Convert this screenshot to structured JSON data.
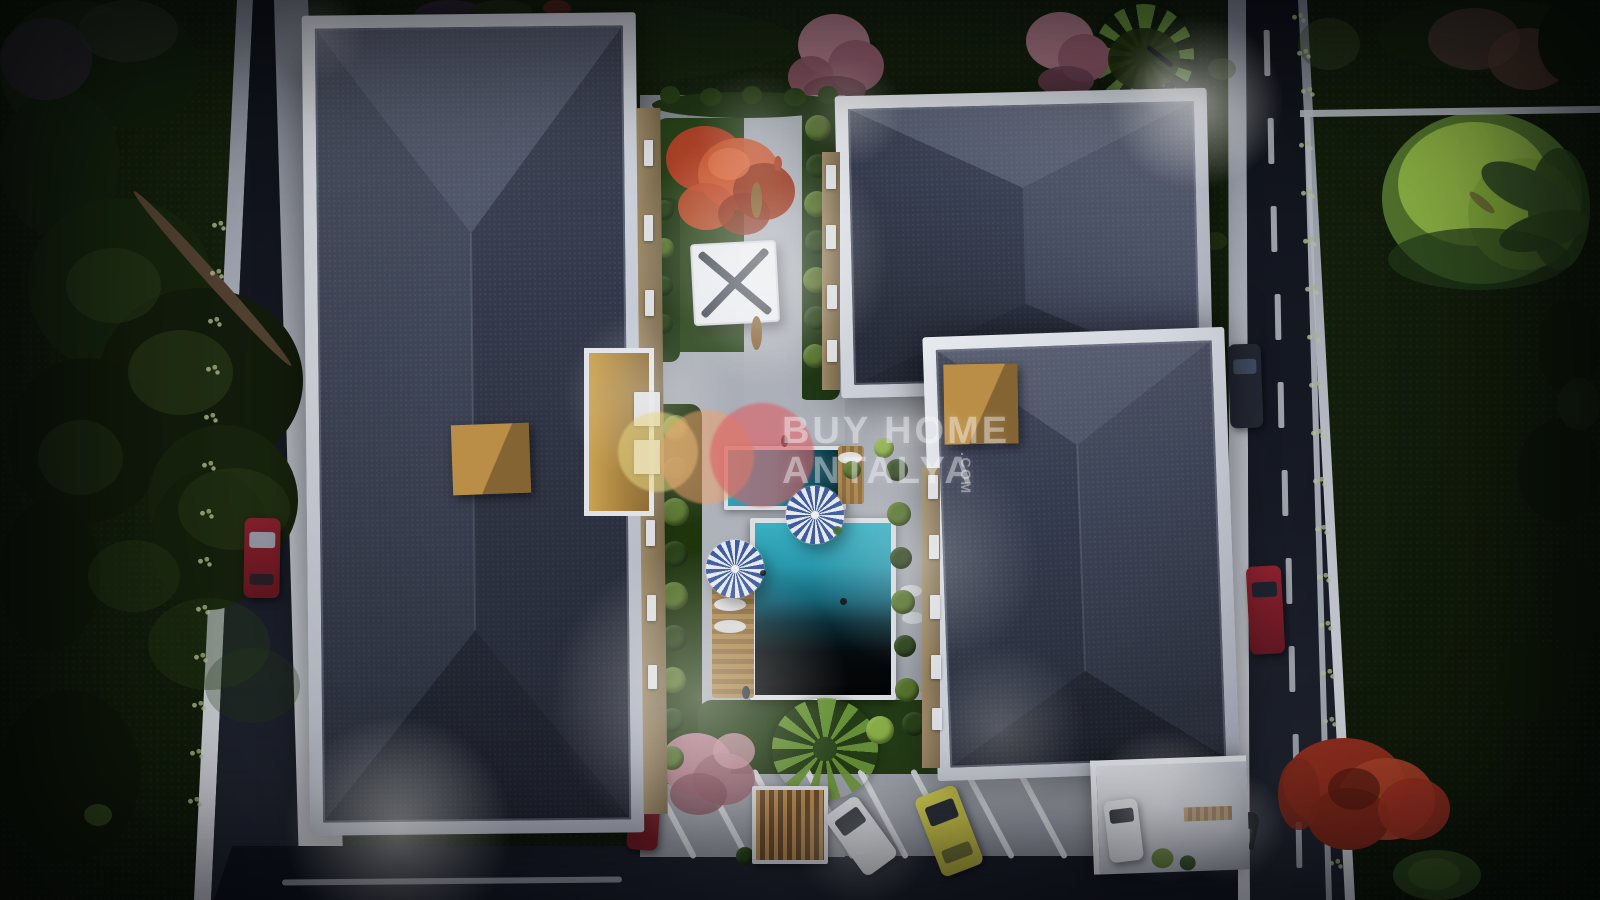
{
  "description": "Aerial night 3D rendering of a two-block residential complex with central courtyard pool, watermarked BUY HOME ANTALYA",
  "watermark": {
    "line1": "BUY HOME",
    "line2": "ANTALYA",
    "suffix": ".COM"
  },
  "palette": {
    "grass_dark": "#0e180a",
    "grass_mid": "#16240e",
    "road_asphalt": "#181c28",
    "sidewalk": "#d8dce3",
    "building_white": "#e9ebef",
    "roof_base": "#3b4153",
    "roof_light": "#4c5368",
    "roof_dark": "#2e3444",
    "courtyard": "#aaaeb6",
    "pool_teal": "#2aa3ba",
    "pool_shadow": "#06080b",
    "parasol_blue": "#3f5ea6",
    "parasol_white": "#eef1f6",
    "wood": "#b08a50",
    "tan_box": "#ab8143",
    "bush_dark": "#2c471b",
    "bush_light": "#5d7c30",
    "bush_lime": "#8fb54a",
    "tree_red": "#c7502f",
    "tree_pink": "#c08b97",
    "tree_flame": "#b03524",
    "willow": "#9fca46",
    "car_red": "#8e2030",
    "car_dark": "#262b38",
    "car_white": "#dfe2e6",
    "car_yellow": "#d6d14f",
    "watermark_text": "rgba(250,250,252,0.42)",
    "logo_yellow": "rgba(232,214,130,0.55)",
    "logo_peach": "rgba(235,160,110,0.55)",
    "logo_red": "rgba(222,95,100,0.6)"
  },
  "scene": {
    "blobs": [
      [
        0,
        0,
        150,
        140,
        "#1a2b10",
        1,
        0,
        2
      ],
      [
        60,
        8,
        140,
        120,
        "#14230d",
        1,
        0,
        2
      ],
      [
        0,
        88,
        120,
        150,
        "#16260f",
        1,
        0,
        2
      ],
      [
        28,
        198,
        185,
        175,
        "#18290f",
        1,
        0,
        2
      ],
      [
        98,
        288,
        205,
        185,
        "#141f0c",
        1,
        0,
        2
      ],
      [
        8,
        358,
        155,
        165,
        "#121d0b",
        1,
        0,
        2
      ],
      [
        148,
        425,
        150,
        150,
        "#19270e",
        1,
        0,
        2
      ],
      [
        150,
        470,
        120,
        140,
        "#16230d",
        1,
        0,
        2
      ],
      [
        0,
        500,
        100,
        150,
        "#111c0a",
        1,
        0,
        2
      ],
      [
        0,
        690,
        140,
        170,
        "#101a09",
        1,
        0,
        2
      ],
      [
        66,
        248,
        95,
        75,
        "#2e441b",
        0.5,
        0,
        2
      ],
      [
        128,
        330,
        105,
        85,
        "#33491c",
        0.5,
        0,
        2
      ],
      [
        38,
        420,
        85,
        75,
        "#2a3f19",
        0.45,
        0,
        2
      ],
      [
        178,
        468,
        112,
        82,
        "#31471c",
        0.4,
        0,
        2
      ],
      [
        88,
        540,
        92,
        72,
        "#2c411a",
        0.4,
        0,
        2
      ],
      [
        148,
        598,
        122,
        92,
        "#2e441b",
        0.35,
        0,
        2
      ],
      [
        205,
        648,
        95,
        75,
        "#2c411a",
        0.3,
        0,
        2
      ],
      [
        0,
        18,
        92,
        82,
        "#3a2f42",
        0.6,
        0,
        2
      ],
      [
        78,
        0,
        100,
        62,
        "#2c3527",
        0.65,
        0,
        2
      ],
      [
        95,
        272,
        235,
        13,
        "#5d4936",
        1,
        48,
        2
      ],
      [
        84,
        804,
        28,
        22,
        "#3c5a22",
        0.8,
        0,
        2
      ],
      [
        298,
        0,
        500,
        85,
        "#1c2c10",
        0.55,
        0,
        1
      ],
      [
        415,
        0,
        70,
        28,
        "#3b2e40",
        0.9,
        0,
        2
      ],
      [
        470,
        0,
        62,
        22,
        "#243617",
        1,
        0,
        2
      ],
      [
        543,
        0,
        28,
        16,
        "#6b2f22",
        0.9,
        0,
        2
      ],
      [
        798,
        14,
        72,
        62,
        "#b57f8c",
        1,
        0,
        2
      ],
      [
        828,
        40,
        56,
        52,
        "#9c6373",
        1,
        0,
        2
      ],
      [
        788,
        56,
        46,
        42,
        "#8e5866",
        0.95,
        0,
        2
      ],
      [
        804,
        76,
        62,
        28,
        "#70414e",
        0.9,
        0,
        2
      ],
      [
        1026,
        12,
        68,
        58,
        "#b57f8c",
        1,
        0,
        2
      ],
      [
        1058,
        34,
        52,
        48,
        "#9c6373",
        1,
        0,
        2
      ],
      [
        1038,
        66,
        56,
        30,
        "#77475a",
        0.9,
        0,
        2
      ],
      [
        1108,
        28,
        72,
        62,
        "#23330f",
        0.9,
        0,
        2
      ],
      [
        652,
        92,
        188,
        26,
        "#223816",
        1,
        0,
        4
      ],
      [
        660,
        86,
        20,
        18,
        "#2a4419",
        1,
        0,
        4
      ],
      [
        700,
        88,
        22,
        18,
        "#2a4419",
        1,
        0,
        4
      ],
      [
        742,
        86,
        20,
        18,
        "#2a4419",
        1,
        0,
        4
      ],
      [
        784,
        88,
        22,
        18,
        "#2a4419",
        1,
        0,
        4
      ],
      [
        818,
        86,
        20,
        18,
        "#2a4419",
        1,
        0,
        4
      ],
      [
        1382,
        112,
        200,
        172,
        "#5d8432",
        1,
        0,
        2
      ],
      [
        1398,
        122,
        152,
        124,
        "#a3cc4d",
        0.95,
        0,
        2
      ],
      [
        1468,
        158,
        112,
        112,
        "#8fbc3e",
        0.95,
        0,
        2
      ],
      [
        1528,
        148,
        62,
        122,
        "#31511e",
        0.85,
        0,
        2
      ],
      [
        1478,
        168,
        92,
        40,
        "#3d5c2a",
        1,
        25,
        2
      ],
      [
        1498,
        213,
        92,
        36,
        "#33511f",
        1,
        -15,
        2
      ],
      [
        1466,
        198,
        32,
        9,
        "#6b5637",
        0.6,
        40,
        2
      ],
      [
        1388,
        228,
        182,
        62,
        "#27421c",
        0.7,
        0,
        2
      ],
      [
        1378,
        0,
        222,
        72,
        "#15230c",
        1,
        0,
        2
      ],
      [
        1428,
        8,
        92,
        62,
        "#4a3a33",
        0.85,
        0,
        2
      ],
      [
        1488,
        28,
        82,
        62,
        "#5f3f33",
        0.7,
        0,
        2
      ],
      [
        1538,
        0,
        62,
        82,
        "#101b09",
        1,
        0,
        2
      ],
      [
        1298,
        18,
        62,
        52,
        "#42552a",
        0.4,
        0,
        2
      ],
      [
        1538,
        300,
        62,
        92,
        "#101c09",
        1,
        0,
        2
      ],
      [
        1518,
        420,
        82,
        102,
        "#0f1b09",
        1,
        0,
        2
      ],
      [
        1552,
        560,
        48,
        92,
        "#111d0a",
        1,
        0,
        2
      ],
      [
        1498,
        640,
        72,
        82,
        "#121e0a",
        0.95,
        0,
        2
      ],
      [
        1558,
        378,
        42,
        52,
        "#1d2f12",
        0.6,
        0,
        2
      ],
      [
        1208,
        58,
        28,
        22,
        "#3e5426",
        0.5,
        0,
        2
      ],
      [
        1203,
        232,
        24,
        18,
        "#36491f",
        0.5,
        0,
        2
      ],
      [
        1283,
        738,
        122,
        92,
        "#a33422",
        1,
        0,
        5
      ],
      [
        1338,
        758,
        97,
        82,
        "#c14a2e",
        0.92,
        0,
        5
      ],
      [
        1308,
        788,
        82,
        62,
        "#8e2c1d",
        1,
        0,
        5
      ],
      [
        1378,
        778,
        72,
        62,
        "#b03524",
        0.88,
        0,
        5
      ],
      [
        1328,
        768,
        52,
        42,
        "#5e1d12",
        0.7,
        0,
        5
      ],
      [
        1278,
        758,
        42,
        72,
        "#922f1f",
        0.85,
        0,
        5
      ],
      [
        1393,
        850,
        88,
        50,
        "#2f4d1e",
        1,
        0,
        5
      ],
      [
        1408,
        858,
        52,
        32,
        "#486c28",
        0.6,
        0,
        5
      ],
      [
        666,
        126,
        78,
        66,
        "#b8462a",
        1,
        0,
        5
      ],
      [
        698,
        138,
        82,
        72,
        "#d55f36",
        0.95,
        0,
        5
      ],
      [
        733,
        163,
        62,
        57,
        "#a03c22",
        1,
        0,
        5
      ],
      [
        678,
        183,
        57,
        47,
        "#c7502f",
        0.9,
        0,
        5
      ],
      [
        718,
        193,
        52,
        42,
        "#8f331d",
        0.85,
        0,
        5
      ],
      [
        708,
        148,
        42,
        32,
        "#e8764a",
        0.75,
        0,
        5
      ],
      [
        660,
        733,
        72,
        62,
        "#bb8693",
        1,
        0,
        5
      ],
      [
        693,
        753,
        62,
        52,
        "#a36b7a",
        0.9,
        0,
        5
      ],
      [
        670,
        773,
        57,
        42,
        "#8e5866",
        0.85,
        0,
        5
      ],
      [
        713,
        733,
        42,
        36,
        "#cf9ba6",
        0.8,
        0,
        5
      ],
      [
        751,
        182,
        11,
        36,
        "#8a6433",
        1,
        0,
        5
      ],
      [
        751,
        316,
        11,
        34,
        "#8a6433",
        1,
        0,
        5
      ],
      [
        714,
        598,
        32,
        13,
        "#eef0f4",
        0.95,
        0,
        5
      ],
      [
        714,
        620,
        32,
        13,
        "#e4e7ec",
        0.9,
        0,
        5
      ],
      [
        838,
        452,
        24,
        12,
        "#eef0f4",
        0.9,
        0,
        5
      ],
      [
        900,
        585,
        22,
        12,
        "#e8eaee",
        0.85,
        0,
        5
      ],
      [
        902,
        612,
        22,
        12,
        "#dfe2e8",
        0.8,
        0,
        5
      ],
      [
        840,
        598,
        7,
        7,
        "#0a0d10",
        0.9,
        0,
        6
      ],
      [
        760,
        570,
        6,
        6,
        "#0a0d10",
        0.8,
        0,
        6
      ],
      [
        833,
        526,
        9,
        9,
        "#3e6b2c",
        0.9,
        0,
        6
      ],
      [
        774,
        156,
        8,
        15,
        "#b5452f",
        1,
        0,
        6
      ],
      [
        781,
        435,
        7,
        12,
        "#2b3038",
        1,
        0,
        6
      ],
      [
        742,
        686,
        8,
        13,
        "#33383f",
        1,
        0,
        6
      ]
    ],
    "bushes": [
      [
        818,
        128,
        13,
        "bush_light"
      ],
      [
        818,
        166,
        12,
        "bush_dark"
      ],
      [
        817,
        204,
        13,
        "bush_light"
      ],
      [
        817,
        242,
        12,
        "bush_dark"
      ],
      [
        816,
        280,
        13,
        "bush_light"
      ],
      [
        816,
        318,
        12,
        "bush_dark"
      ],
      [
        815,
        356,
        12,
        "bush_light"
      ],
      [
        664,
        210,
        10,
        "bush_dark"
      ],
      [
        664,
        248,
        10,
        "bush_light"
      ],
      [
        663,
        286,
        10,
        "bush_dark"
      ],
      [
        663,
        324,
        10,
        "bush_dark"
      ],
      [
        676,
        428,
        13,
        "bush_light"
      ],
      [
        676,
        470,
        13,
        "bush_dark"
      ],
      [
        675,
        512,
        14,
        "bush_light"
      ],
      [
        675,
        554,
        13,
        "bush_dark"
      ],
      [
        674,
        596,
        14,
        "bush_light"
      ],
      [
        674,
        638,
        13,
        "bush_dark"
      ],
      [
        673,
        680,
        13,
        "bush_light"
      ],
      [
        672,
        720,
        12,
        "bush_dark"
      ],
      [
        672,
        758,
        12,
        "bush_light"
      ],
      [
        897,
        470,
        11,
        "bush_dark"
      ],
      [
        899,
        514,
        12,
        "bush_light"
      ],
      [
        901,
        558,
        11,
        "bush_dark"
      ],
      [
        903,
        602,
        12,
        "bush_light"
      ],
      [
        905,
        646,
        11,
        "bush_dark"
      ],
      [
        907,
        690,
        12,
        "bush_light"
      ],
      [
        880,
        730,
        14,
        "bush_lime"
      ],
      [
        914,
        724,
        12,
        "bush_dark"
      ],
      [
        947,
        730,
        14,
        "bush_lime"
      ],
      [
        979,
        726,
        12,
        "bush_dark"
      ],
      [
        1009,
        730,
        14,
        "bush_lime"
      ],
      [
        1031,
        740,
        11,
        "bush_dark"
      ],
      [
        884,
        448,
        10,
        "bush_lime"
      ],
      [
        852,
        470,
        9,
        "bush_light"
      ],
      [
        745,
        856,
        9,
        "bush_dark"
      ],
      [
        640,
        798,
        10,
        "bush_dark"
      ],
      [
        650,
        826,
        8,
        "bush_dark"
      ]
    ],
    "flowers": [
      [
        210,
        220
      ],
      [
        208,
        268
      ],
      [
        206,
        316
      ],
      [
        204,
        364
      ],
      [
        202,
        412
      ],
      [
        200,
        460
      ],
      [
        198,
        508
      ],
      [
        196,
        556
      ],
      [
        194,
        604
      ],
      [
        192,
        652
      ],
      [
        190,
        700
      ],
      [
        188,
        748
      ],
      [
        186,
        796
      ],
      [
        1297,
        140
      ],
      [
        1299,
        188
      ],
      [
        1301,
        236
      ],
      [
        1303,
        284
      ],
      [
        1305,
        332
      ],
      [
        1307,
        380
      ],
      [
        1309,
        428
      ],
      [
        1311,
        476
      ],
      [
        1313,
        524
      ],
      [
        1315,
        572
      ],
      [
        1317,
        620
      ],
      [
        1319,
        668
      ],
      [
        1321,
        716
      ],
      [
        1323,
        764
      ],
      [
        1325,
        812
      ],
      [
        1327,
        858
      ],
      [
        1290,
        12
      ],
      [
        1295,
        48
      ],
      [
        1299,
        86
      ]
    ],
    "glows": [
      [
        760,
        258,
        130,
        0.4
      ],
      [
        648,
        395,
        85,
        0.28
      ],
      [
        700,
        698,
        150,
        0.38
      ],
      [
        925,
        560,
        115,
        0.25
      ],
      [
        1000,
        728,
        85,
        0.22
      ],
      [
        398,
        830,
        115,
        0.45
      ],
      [
        1196,
        102,
        88,
        0.6
      ],
      [
        848,
        112,
        55,
        0.28
      ],
      [
        318,
        34,
        48,
        0.2
      ],
      [
        1165,
        806,
        78,
        0.38
      ],
      [
        1228,
        826,
        58,
        0.28
      ],
      [
        757,
        305,
        75,
        0.18
      ],
      [
        862,
        840,
        70,
        0.25
      ],
      [
        676,
        472,
        55,
        0.15
      ],
      [
        905,
        440,
        60,
        0.2
      ],
      [
        755,
        130,
        60,
        0.22
      ],
      [
        1167,
        86,
        34,
        0.3
      ]
    ],
    "parking_lines": [
      668,
      721,
      774,
      827,
      880,
      933,
      986,
      1039
    ],
    "center_line": {
      "x0": 1264,
      "x1": 1298,
      "y0": 30,
      "y1": 860,
      "step": 88,
      "w": 6,
      "h": 46
    },
    "windows": [
      [
        644,
        140,
        9,
        26
      ],
      [
        644,
        215,
        9,
        26
      ],
      [
        645,
        290,
        9,
        26
      ],
      [
        646,
        520,
        9,
        26
      ],
      [
        647,
        595,
        9,
        26
      ],
      [
        648,
        665,
        9,
        24
      ],
      [
        634,
        392,
        26,
        34
      ],
      [
        634,
        440,
        26,
        34
      ],
      [
        826,
        165,
        10,
        24
      ],
      [
        826,
        225,
        10,
        24
      ],
      [
        827,
        285,
        10,
        24
      ],
      [
        827,
        340,
        10,
        22
      ],
      [
        928,
        475,
        10,
        24
      ],
      [
        929,
        535,
        10,
        24
      ],
      [
        930,
        595,
        10,
        24
      ],
      [
        931,
        655,
        10,
        24
      ],
      [
        932,
        708,
        10,
        22
      ]
    ]
  }
}
